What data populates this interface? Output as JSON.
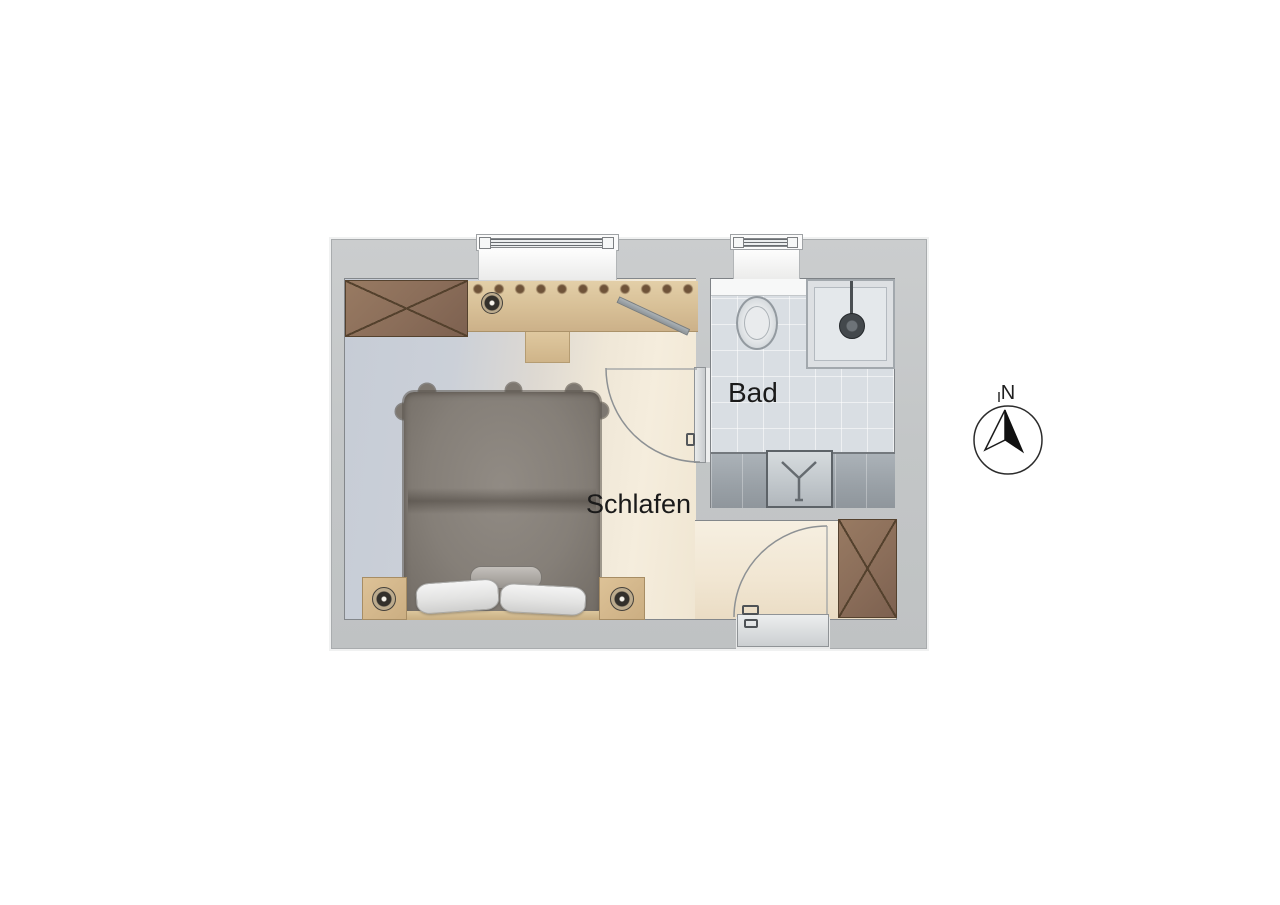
{
  "plan": {
    "rooms": [
      {
        "id": "schlafen",
        "label": "Schlafen"
      },
      {
        "id": "bad",
        "label": "Bad"
      }
    ],
    "compass": {
      "north_label": "N"
    },
    "furniture": [
      "double-bed",
      "pillows",
      "bolster-cushion",
      "nightstand-left",
      "nightstand-right",
      "wardrobe-top-left",
      "wardrobe-bottom-right",
      "desk-with-knob-rail",
      "desk-lamp",
      "stool",
      "wall-rack",
      "toilet",
      "shower",
      "sink-counter",
      "window-bedroom",
      "window-bathroom",
      "entry-door",
      "bathroom-door"
    ],
    "colors": {
      "wall": "#c6c8c9",
      "wall_edge": "#85898c",
      "carpet": "#c8cdd6",
      "wood_floor": "#f2e9d9",
      "furniture_wood": "#d9c199",
      "wardrobe": "#8d7160",
      "bed": "#87817a",
      "bath_tile": "#d9dee3",
      "counter": "#9ba3a9",
      "label_text": "#1a1a1a"
    }
  }
}
